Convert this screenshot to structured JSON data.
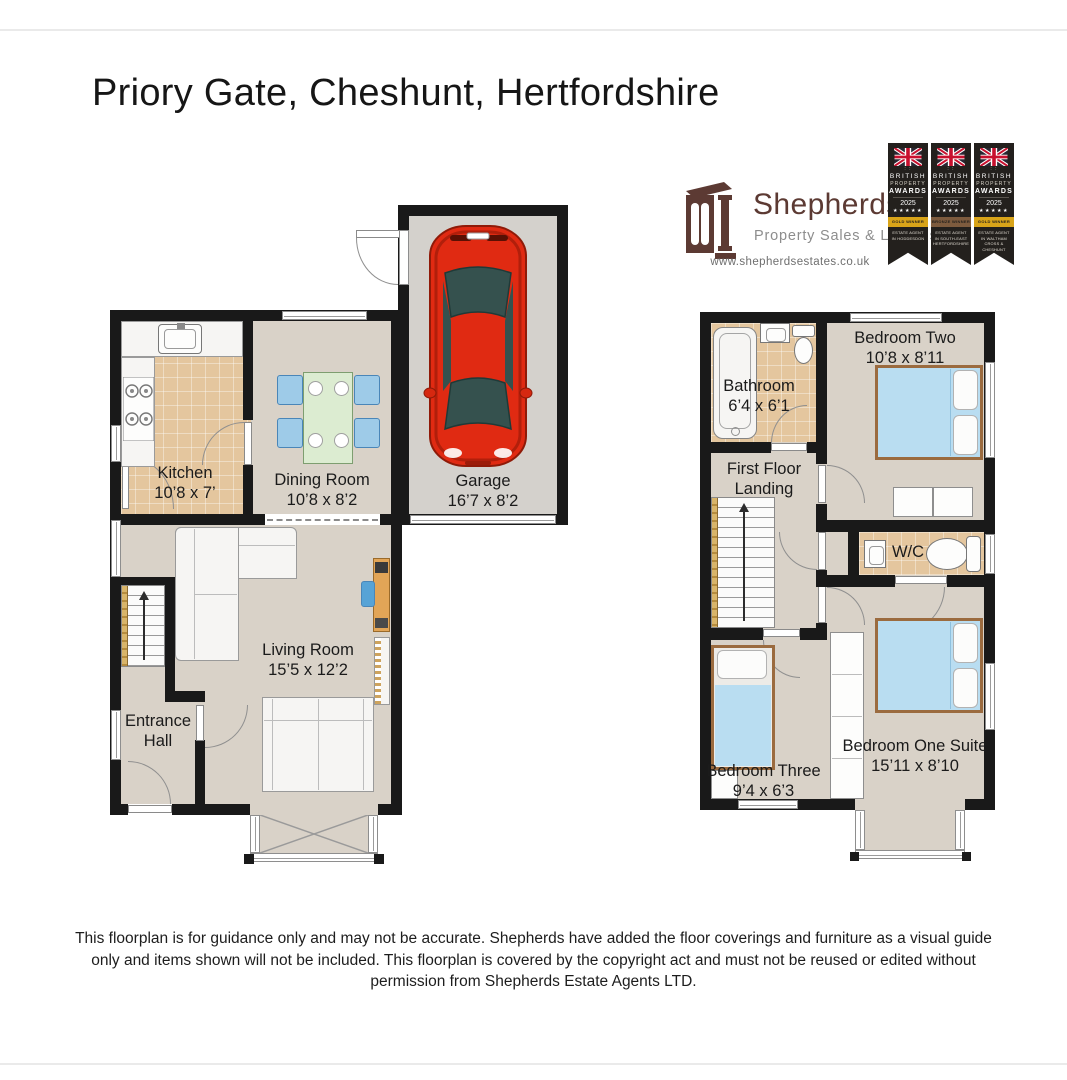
{
  "page": {
    "title": "Priory Gate, Cheshunt, Hertfordshire",
    "disclaimer": "This floorplan is for guidance only and may not be accurate. Shepherds have added the floor coverings and furniture as a visual guide only and items shown will not be included. This floorplan is covered by the copyright act and must not be reused or edited without permission from Shepherds Estate Agents LTD."
  },
  "branding": {
    "name": "Shepherds",
    "tagline": "Property Sales & Lettings",
    "website": "www.shepherdsestates.co.uk",
    "brand_color": "#5c3a33"
  },
  "awards": [
    {
      "org1": "BRITISH",
      "org2": "PROPERTY",
      "org3": "AWARDS",
      "year": "2025",
      "stars": "★★★★★",
      "level": "GOLD WINNER",
      "region": "ESTATE AGENT IN HODDESDON",
      "band_color": "#d9a419"
    },
    {
      "org1": "BRITISH",
      "org2": "PROPERTY",
      "org3": "AWARDS",
      "year": "2025",
      "stars": "★★★★★",
      "level": "BRONZE WINNER",
      "region": "ESTATE AGENT IN SOUTH-EAST HERTFORDSHIRE",
      "band_color": "#7d5b3e"
    },
    {
      "org1": "BRITISH",
      "org2": "PROPERTY",
      "org3": "AWARDS",
      "year": "2025",
      "stars": "★★★★★",
      "level": "GOLD WINNER",
      "region": "ESTATE AGENT IN WALTHAM CROSS & CHESHUNT",
      "band_color": "#d9a419"
    }
  ],
  "ground_floor": {
    "kitchen": {
      "name": "Kitchen",
      "dims": "10’8 x 7’"
    },
    "dining": {
      "name": "Dining Room",
      "dims": "10’8 x 8’2"
    },
    "garage": {
      "name": "Garage",
      "dims": "16’7 x 8’2"
    },
    "living": {
      "name": "Living Room",
      "dims": "15’5 x 12’2"
    },
    "entrance": {
      "name": "Entrance Hall"
    }
  },
  "first_floor": {
    "bathroom": {
      "name": "Bathroom",
      "dims": "6’4 x 6’1"
    },
    "bedroom2": {
      "name": "Bedroom Two",
      "dims": "10’8 x 8’11"
    },
    "landing": {
      "name": "First Floor Landing"
    },
    "wc": {
      "name": "W/C"
    },
    "bedroom3": {
      "name": "Bedroom Three",
      "dims": "9’4 x 6’3"
    },
    "bedroom1": {
      "name": "Bedroom One Suite",
      "dims": "15’11 x 8’10"
    }
  }
}
